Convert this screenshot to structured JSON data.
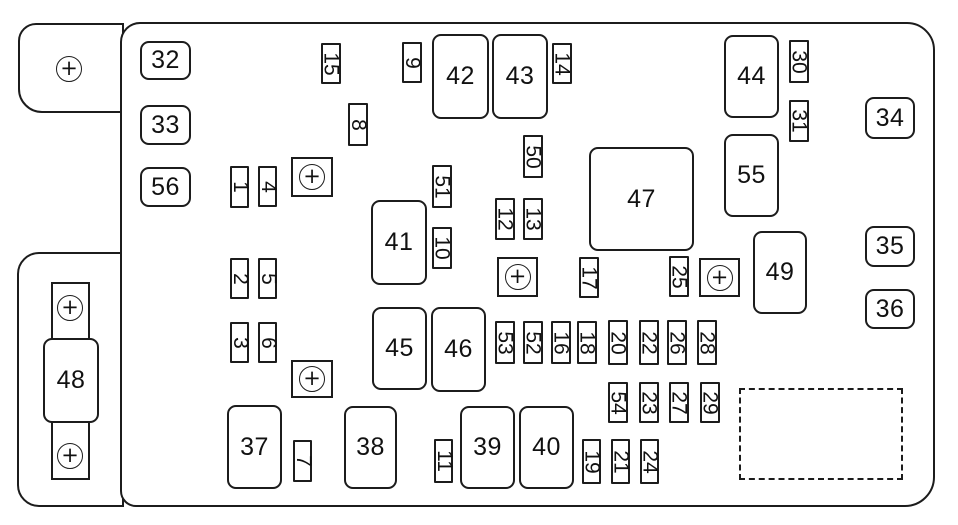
{
  "diagram_type": "fuse-box-diagram",
  "bolt_symbol": "+",
  "colors": {
    "line": "#1c1c1c",
    "background": "#ffffff"
  },
  "relays": [
    {
      "label": "32",
      "x": 140,
      "y": 41,
      "w": 51,
      "h": 39
    },
    {
      "label": "33",
      "x": 140,
      "y": 105,
      "w": 51,
      "h": 40
    },
    {
      "label": "56",
      "x": 140,
      "y": 167,
      "w": 51,
      "h": 40
    },
    {
      "label": "34",
      "x": 865,
      "y": 97,
      "w": 50,
      "h": 42
    },
    {
      "label": "35",
      "x": 865,
      "y": 226,
      "w": 50,
      "h": 41
    },
    {
      "label": "36",
      "x": 865,
      "y": 289,
      "w": 50,
      "h": 40
    },
    {
      "label": "42",
      "x": 432,
      "y": 34,
      "w": 57,
      "h": 85
    },
    {
      "label": "43",
      "x": 492,
      "y": 34,
      "w": 56,
      "h": 85
    },
    {
      "label": "44",
      "x": 724,
      "y": 35,
      "w": 55,
      "h": 83
    },
    {
      "label": "55",
      "x": 724,
      "y": 134,
      "w": 55,
      "h": 83
    },
    {
      "label": "47",
      "x": 589,
      "y": 147,
      "w": 105,
      "h": 104
    },
    {
      "label": "41",
      "x": 371,
      "y": 200,
      "w": 56,
      "h": 85
    },
    {
      "label": "49",
      "x": 753,
      "y": 231,
      "w": 54,
      "h": 83
    },
    {
      "label": "45",
      "x": 372,
      "y": 307,
      "w": 55,
      "h": 83
    },
    {
      "label": "46",
      "x": 431,
      "y": 307,
      "w": 55,
      "h": 85
    },
    {
      "label": "37",
      "x": 227,
      "y": 405,
      "w": 55,
      "h": 84
    },
    {
      "label": "38",
      "x": 344,
      "y": 406,
      "w": 53,
      "h": 83
    },
    {
      "label": "39",
      "x": 460,
      "y": 406,
      "w": 55,
      "h": 83
    },
    {
      "label": "40",
      "x": 519,
      "y": 406,
      "w": 55,
      "h": 83
    },
    {
      "label": "48",
      "x": 43,
      "y": 338,
      "w": 56,
      "h": 85
    }
  ],
  "fuses": [
    {
      "label": "15",
      "x": 321,
      "y": 43,
      "w": 20,
      "h": 41
    },
    {
      "label": "9",
      "x": 402,
      "y": 42,
      "w": 20,
      "h": 41
    },
    {
      "label": "14",
      "x": 552,
      "y": 43,
      "w": 20,
      "h": 41
    },
    {
      "label": "30",
      "x": 789,
      "y": 40,
      "w": 20,
      "h": 43
    },
    {
      "label": "31",
      "x": 789,
      "y": 100,
      "w": 20,
      "h": 42
    },
    {
      "label": "8",
      "x": 348,
      "y": 103,
      "w": 20,
      "h": 43
    },
    {
      "label": "50",
      "x": 523,
      "y": 135,
      "w": 20,
      "h": 43
    },
    {
      "label": "1",
      "x": 230,
      "y": 166,
      "w": 19,
      "h": 42
    },
    {
      "label": "4",
      "x": 258,
      "y": 166,
      "w": 19,
      "h": 41
    },
    {
      "label": "51",
      "x": 432,
      "y": 165,
      "w": 20,
      "h": 43
    },
    {
      "label": "12",
      "x": 495,
      "y": 198,
      "w": 20,
      "h": 42
    },
    {
      "label": "13",
      "x": 523,
      "y": 198,
      "w": 20,
      "h": 42
    },
    {
      "label": "10",
      "x": 432,
      "y": 227,
      "w": 20,
      "h": 42
    },
    {
      "label": "17",
      "x": 579,
      "y": 257,
      "w": 20,
      "h": 41
    },
    {
      "label": "25",
      "x": 669,
      "y": 256,
      "w": 20,
      "h": 41
    },
    {
      "label": "2",
      "x": 230,
      "y": 258,
      "w": 19,
      "h": 41
    },
    {
      "label": "5",
      "x": 258,
      "y": 258,
      "w": 19,
      "h": 41
    },
    {
      "label": "3",
      "x": 230,
      "y": 322,
      "w": 19,
      "h": 41
    },
    {
      "label": "6",
      "x": 258,
      "y": 322,
      "w": 19,
      "h": 41
    },
    {
      "label": "53",
      "x": 495,
      "y": 321,
      "w": 20,
      "h": 43
    },
    {
      "label": "52",
      "x": 523,
      "y": 321,
      "w": 20,
      "h": 43
    },
    {
      "label": "16",
      "x": 551,
      "y": 321,
      "w": 20,
      "h": 43
    },
    {
      "label": "18",
      "x": 577,
      "y": 321,
      "w": 20,
      "h": 43
    },
    {
      "label": "20",
      "x": 608,
      "y": 320,
      "w": 20,
      "h": 45
    },
    {
      "label": "22",
      "x": 639,
      "y": 320,
      "w": 20,
      "h": 45
    },
    {
      "label": "26",
      "x": 667,
      "y": 320,
      "w": 20,
      "h": 45
    },
    {
      "label": "28",
      "x": 697,
      "y": 320,
      "w": 20,
      "h": 45
    },
    {
      "label": "54",
      "x": 608,
      "y": 382,
      "w": 20,
      "h": 41
    },
    {
      "label": "23",
      "x": 639,
      "y": 382,
      "w": 20,
      "h": 41
    },
    {
      "label": "27",
      "x": 669,
      "y": 382,
      "w": 20,
      "h": 41
    },
    {
      "label": "29",
      "x": 700,
      "y": 382,
      "w": 20,
      "h": 41
    },
    {
      "label": "19",
      "x": 582,
      "y": 439,
      "w": 19,
      "h": 45
    },
    {
      "label": "21",
      "x": 611,
      "y": 439,
      "w": 19,
      "h": 45
    },
    {
      "label": "24",
      "x": 640,
      "y": 439,
      "w": 19,
      "h": 45
    },
    {
      "label": "7",
      "x": 293,
      "y": 440,
      "w": 19,
      "h": 42
    },
    {
      "label": "11",
      "x": 434,
      "y": 439,
      "w": 19,
      "h": 44
    }
  ],
  "bolt_squares": [
    {
      "x": 291,
      "y": 157,
      "w": 42,
      "h": 40
    },
    {
      "x": 291,
      "y": 360,
      "w": 42,
      "h": 38
    },
    {
      "x": 497,
      "y": 257,
      "w": 41,
      "h": 40
    },
    {
      "x": 699,
      "y": 258,
      "w": 41,
      "h": 39
    }
  ],
  "bolt_circles": [
    {
      "cx": 69,
      "cy": 69
    },
    {
      "cx": 70,
      "cy": 308
    },
    {
      "cx": 70,
      "cy": 456
    }
  ],
  "empty_slot": {
    "x": 739,
    "y": 388,
    "w": 164,
    "h": 92
  }
}
